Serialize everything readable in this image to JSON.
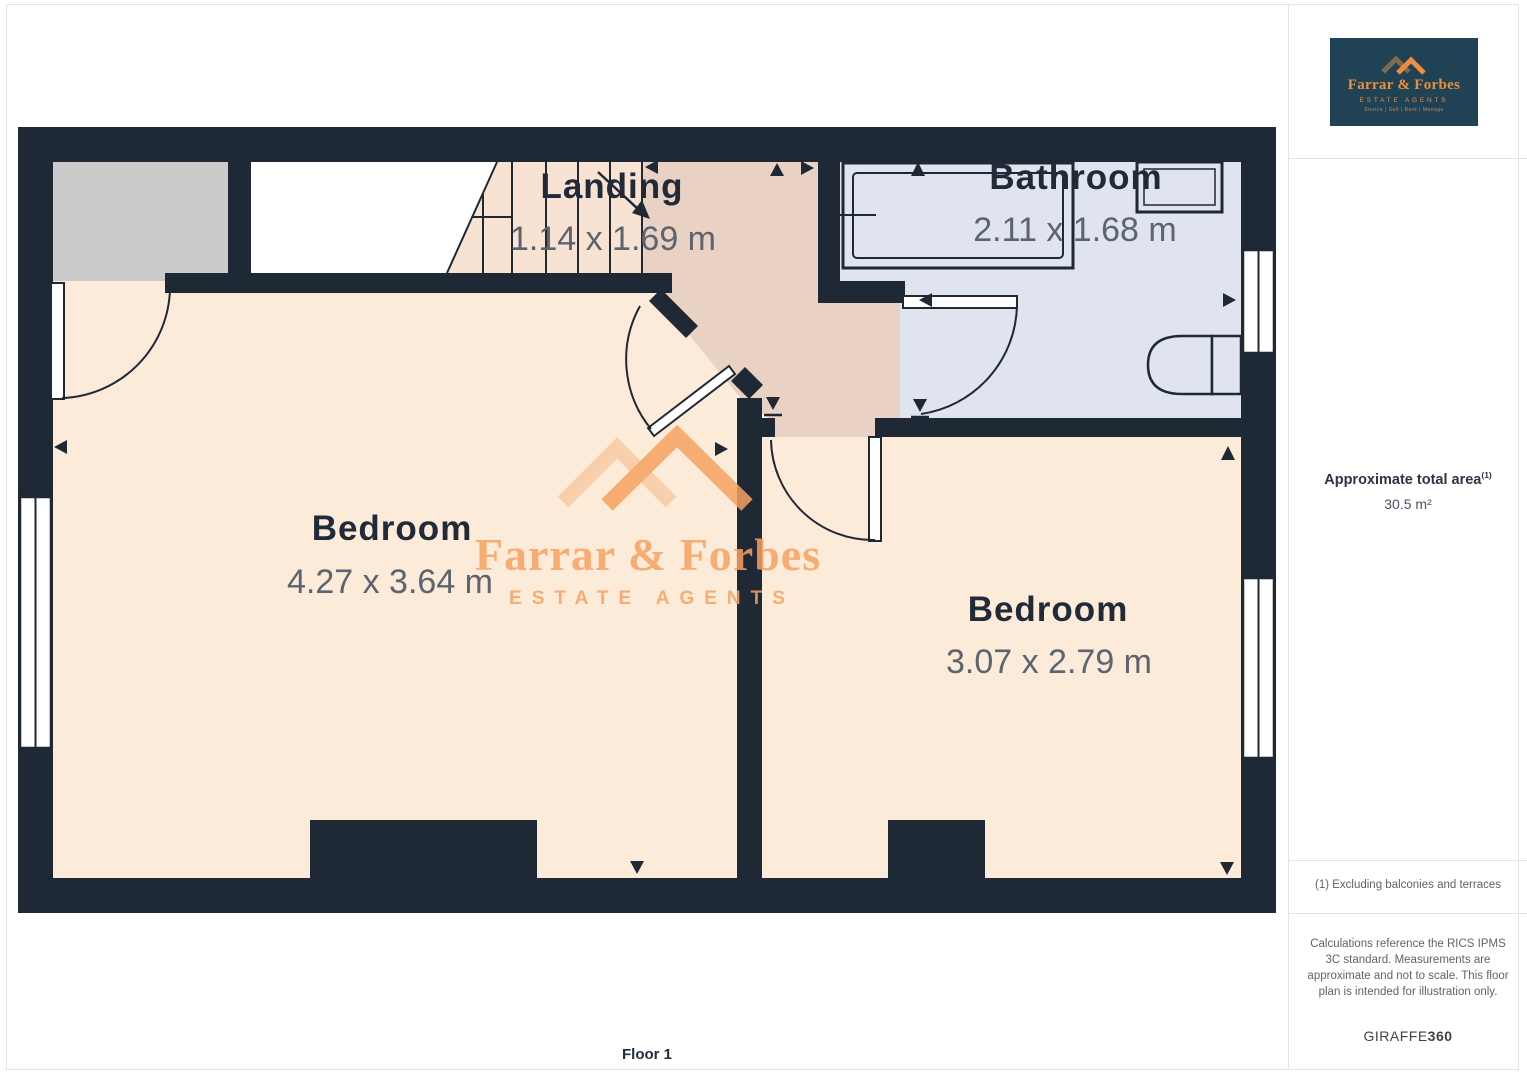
{
  "page": {
    "floor_label": "Floor 1"
  },
  "plan": {
    "rooms": [
      {
        "name": "Landing",
        "dimensions": "1.14 x 1.69 m"
      },
      {
        "name": "Bathroom",
        "dimensions": "2.11 x 1.68 m"
      },
      {
        "name": "Bedroom",
        "dimensions": "4.27 x 3.64 m"
      },
      {
        "name": "Bedroom",
        "dimensions": "3.07 x 2.79 m"
      }
    ],
    "fixtures": [
      "stairs",
      "bathtub",
      "sink",
      "toilet"
    ],
    "colors": {
      "wall": "#1f2835",
      "bedroom_floor": "#fdebda",
      "landing_floor": "#e9d1c4",
      "stairs_floor": "#f8e3d2",
      "bathroom_floor": "#e0e4ef",
      "closet_gray": "#cbcbcb",
      "label_text": "#202a38",
      "dimension_text": "#5c6470",
      "watermark_orange": "#f7a261",
      "logo_background": "#1f4355",
      "logo_orange": "#ee8d3d"
    }
  },
  "watermark": {
    "name": "Farrar & Forbes",
    "subtitle": "ESTATE AGENTS"
  },
  "sidebar": {
    "logo": {
      "name": "Farrar & Forbes",
      "subtitle": "ESTATE AGENTS",
      "tagline": "Source | Sell | Rent | Manage"
    },
    "area_label": "Approximate total area",
    "area_superscript": "(1)",
    "area_value": "30.5 m²",
    "footnote": "(1) Excluding balconies and terraces",
    "disclaimer": "Calculations reference the RICS IPMS 3C standard. Measurements are approximate and not to scale. This floor plan is intended for illustration only.",
    "brand": "GIRAFFE",
    "brand_suffix": "360"
  }
}
